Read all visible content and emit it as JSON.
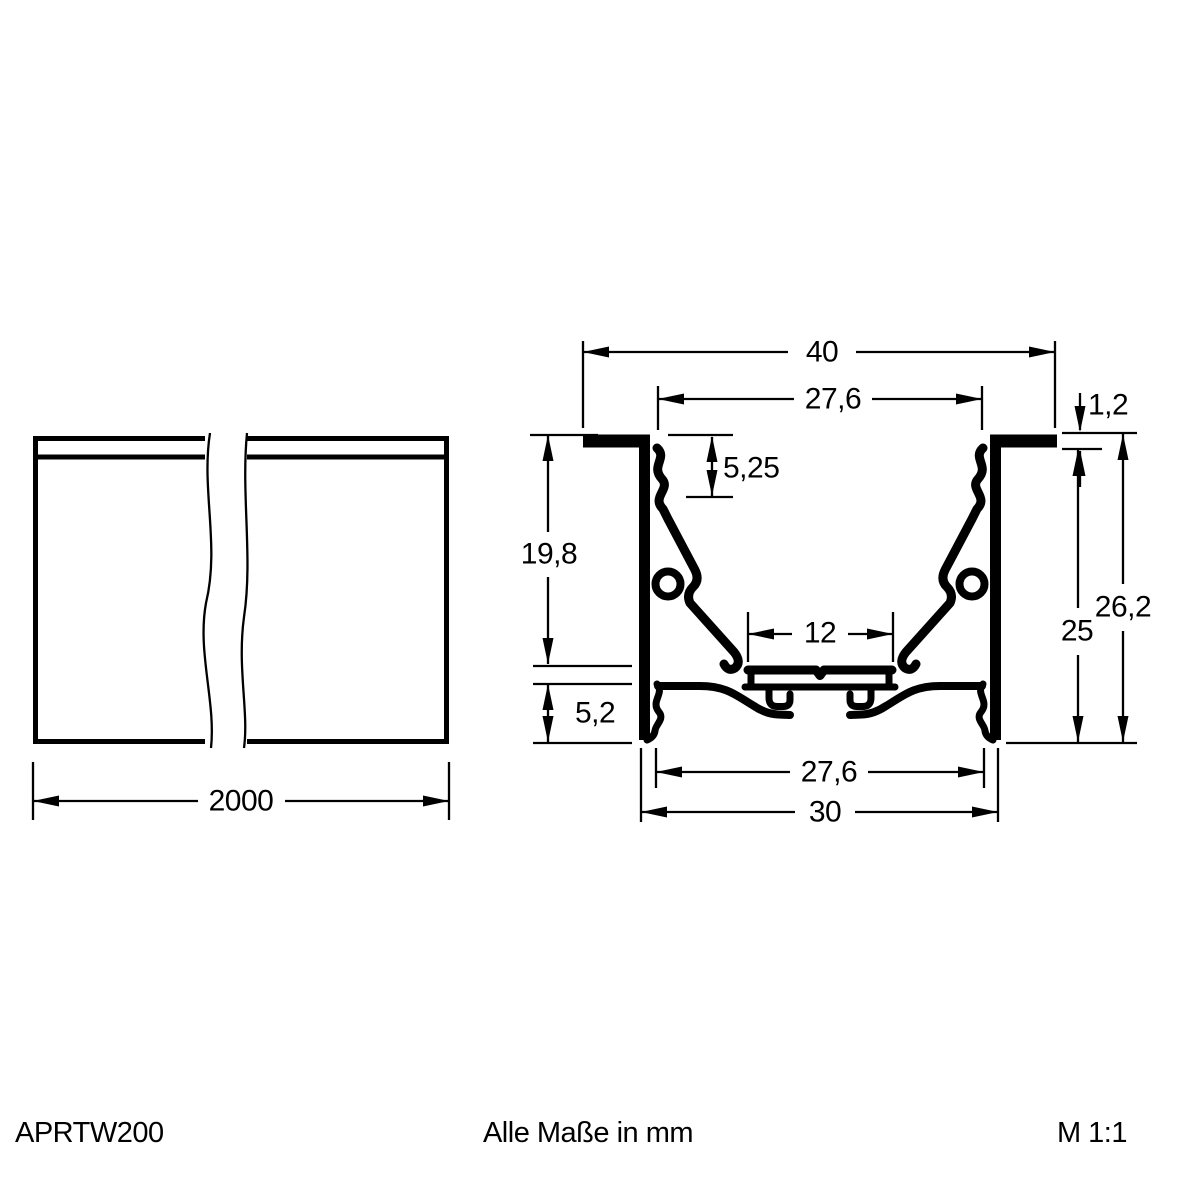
{
  "drawing": {
    "background_color": "#ffffff",
    "line_color": "#000000"
  },
  "side_view": {
    "length": "2000"
  },
  "cross_section": {
    "overall_width": "40",
    "top_inner_width": "27,6",
    "flange_thickness": "1,2",
    "groove_depth": "5,25",
    "inner_depth": "19,8",
    "overall_height": "26,2",
    "wall_height": "25",
    "slot_width": "12",
    "base_height": "5,2",
    "bottom_inner_width": "27,6",
    "bottom_outer_width": "30"
  },
  "footer": {
    "article_number": "APRTW200",
    "units_note": "Alle Maße in mm",
    "scale": "M 1:1"
  }
}
